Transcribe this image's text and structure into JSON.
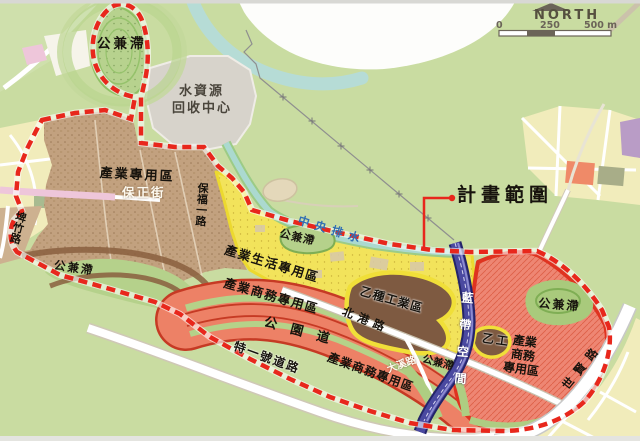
{
  "compass": {
    "label": "NORTH"
  },
  "scale": {
    "tick_0": "0",
    "tick_250": "250",
    "tick_500": "500 m"
  },
  "labels": {
    "plan_scope": "計畫範圍",
    "pond_nw": "公兼滯",
    "water_plant_line1": "水資源",
    "water_plant_line2": "回收中心",
    "industry_special": "產業專用區",
    "baozheng_street": "保正街",
    "baofu_1st_road": "保福一路",
    "pond_west": "公兼滯",
    "industry_life": "產業生活專用區",
    "pond_mid": "公兼滯",
    "central_drainage": "中央排水",
    "industry_biz_main": "產業商務專用區",
    "park_avenue": "公園道",
    "beigang_road": "北港路",
    "type_b_industrial": "乙種工業區",
    "special_road_1": "特一號道路",
    "industry_biz_south": "產業商務專用區",
    "pond_rail": "公兼滯",
    "daxi_road": "大溪路",
    "type_b_small": "乙工",
    "blue_belt": "藍帶空間",
    "biz_right_line1": "產業",
    "biz_right_line2": "商務",
    "biz_right_line3": "專用區",
    "pond_east": "公兼滯",
    "shixian_road": "世賢路",
    "pizhu_road": "埤竹路"
  },
  "colors": {
    "boundary_red": "#e8271c",
    "background_green": "#c9dca1",
    "industry_brown": "#c2a17f",
    "life_yellow": "#f2e35b",
    "biz_salmon": "#ed8166",
    "type_b_dark_brown": "#7e5a41",
    "pond_green": "#b5d18b",
    "blue_belt_navy": "#3b3a8e",
    "water_teal": "#aed9d0",
    "plant_gray": "#d7d3cb",
    "drain_label_blue": "#2f6eb4"
  }
}
